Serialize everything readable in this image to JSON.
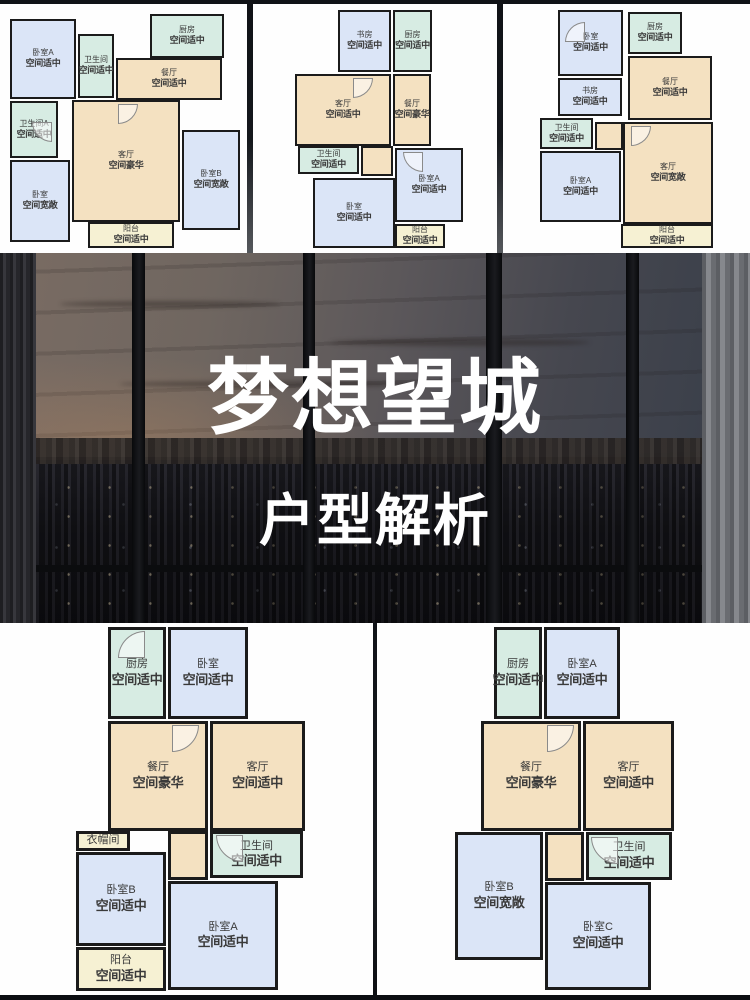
{
  "hero": {
    "title": "梦想望城",
    "subtitle": "户型解析"
  },
  "palette": {
    "bedroom": "#dbe5f7",
    "utility": "#d7ece3",
    "living": "#f4e1c1",
    "balcony": "#f6f1d3",
    "wall": "#1b1b1b",
    "card": "#fefefe",
    "text": "#3a3a3a"
  },
  "plans": [
    {
      "id": "plan-top-left",
      "rooms": [
        {
          "name": "卧室A",
          "grade": "空间适中",
          "type": "bedroom",
          "x": 10,
          "y": 15,
          "w": 66,
          "h": 80
        },
        {
          "name": "卫生间",
          "grade": "空间适中",
          "type": "utility",
          "x": 78,
          "y": 30,
          "w": 36,
          "h": 64
        },
        {
          "name": "厨房",
          "grade": "空间适中",
          "type": "utility",
          "x": 150,
          "y": 10,
          "w": 74,
          "h": 44
        },
        {
          "name": "餐厅",
          "grade": "空间适中",
          "type": "living",
          "x": 116,
          "y": 54,
          "w": 106,
          "h": 42
        },
        {
          "name": "卫生间A",
          "grade": "空间适中",
          "type": "utility",
          "x": 10,
          "y": 97,
          "w": 48,
          "h": 57
        },
        {
          "name": "客厅",
          "grade": "空间豪华",
          "type": "living",
          "x": 72,
          "y": 96,
          "w": 108,
          "h": 122
        },
        {
          "name": "卧室",
          "grade": "空间宽敞",
          "type": "bedroom",
          "x": 10,
          "y": 156,
          "w": 60,
          "h": 82
        },
        {
          "name": "卧室B",
          "grade": "空间宽敞",
          "type": "bedroom",
          "x": 182,
          "y": 126,
          "w": 58,
          "h": 100
        },
        {
          "name": "阳台",
          "grade": "空间适中",
          "type": "balcony",
          "x": 88,
          "y": 218,
          "w": 86,
          "h": 26
        }
      ],
      "doors": [
        {
          "x": 118,
          "y": 100,
          "rot": 0
        },
        {
          "x": 32,
          "y": 118,
          "rot": 90
        }
      ]
    },
    {
      "id": "plan-top-middle",
      "rooms": [
        {
          "name": "书房",
          "grade": "空间适中",
          "type": "bedroom",
          "x": 85,
          "y": 6,
          "w": 53,
          "h": 62
        },
        {
          "name": "厨房",
          "grade": "空间适中",
          "type": "utility",
          "x": 140,
          "y": 6,
          "w": 39,
          "h": 62
        },
        {
          "name": "客厅",
          "grade": "空间适中",
          "type": "living",
          "x": 42,
          "y": 70,
          "w": 96,
          "h": 72
        },
        {
          "name": "餐厅",
          "grade": "空间豪华",
          "type": "living",
          "x": 140,
          "y": 70,
          "w": 38,
          "h": 72
        },
        {
          "name": "",
          "grade": "",
          "type": "living",
          "x": 108,
          "y": 142,
          "w": 32,
          "h": 30
        },
        {
          "name": "卫生间",
          "grade": "空间适中",
          "type": "utility",
          "x": 45,
          "y": 142,
          "w": 61,
          "h": 28
        },
        {
          "name": "卧室A",
          "grade": "空间适中",
          "type": "bedroom",
          "x": 142,
          "y": 144,
          "w": 68,
          "h": 74
        },
        {
          "name": "卧室",
          "grade": "空间适中",
          "type": "bedroom",
          "x": 60,
          "y": 174,
          "w": 82,
          "h": 70
        },
        {
          "name": "阳台",
          "grade": "空间适中",
          "type": "balcony",
          "x": 142,
          "y": 220,
          "w": 50,
          "h": 24
        }
      ],
      "doors": [
        {
          "x": 100,
          "y": 74,
          "rot": 0
        },
        {
          "x": 150,
          "y": 148,
          "rot": 90
        }
      ]
    },
    {
      "id": "plan-top-right",
      "rooms": [
        {
          "name": "卧室",
          "grade": "空间适中",
          "type": "bedroom",
          "x": 55,
          "y": 6,
          "w": 65,
          "h": 66
        },
        {
          "name": "厨房",
          "grade": "空间适中",
          "type": "utility",
          "x": 125,
          "y": 8,
          "w": 54,
          "h": 42
        },
        {
          "name": "餐厅",
          "grade": "空间适中",
          "type": "living",
          "x": 125,
          "y": 52,
          "w": 84,
          "h": 64
        },
        {
          "name": "书房",
          "grade": "空间适中",
          "type": "bedroom",
          "x": 55,
          "y": 74,
          "w": 64,
          "h": 38
        },
        {
          "name": "卫生间",
          "grade": "空间适中",
          "type": "utility",
          "x": 37,
          "y": 114,
          "w": 53,
          "h": 31
        },
        {
          "name": "",
          "grade": "",
          "type": "living",
          "x": 92,
          "y": 118,
          "w": 28,
          "h": 28
        },
        {
          "name": "客厅",
          "grade": "空间宽敞",
          "type": "living",
          "x": 120,
          "y": 118,
          "w": 90,
          "h": 102
        },
        {
          "name": "卧室A",
          "grade": "空间适中",
          "type": "bedroom",
          "x": 37,
          "y": 147,
          "w": 81,
          "h": 71
        },
        {
          "name": "阳台",
          "grade": "空间适中",
          "type": "balcony",
          "x": 118,
          "y": 220,
          "w": 92,
          "h": 24
        }
      ],
      "doors": [
        {
          "x": 128,
          "y": 122,
          "rot": 0
        },
        {
          "x": 62,
          "y": 18,
          "rot": 180
        }
      ]
    },
    {
      "id": "plan-bottom-left",
      "rooms": [
        {
          "name": "厨房",
          "grade": "空间适中",
          "type": "utility",
          "x": 108,
          "y": 4,
          "w": 58,
          "h": 92
        },
        {
          "name": "卧室",
          "grade": "空间适中",
          "type": "bedroom",
          "x": 168,
          "y": 4,
          "w": 80,
          "h": 92
        },
        {
          "name": "餐厅",
          "grade": "空间豪华",
          "type": "living",
          "x": 108,
          "y": 98,
          "w": 100,
          "h": 110
        },
        {
          "name": "客厅",
          "grade": "空间适中",
          "type": "living",
          "x": 210,
          "y": 98,
          "w": 95,
          "h": 110
        },
        {
          "name": "",
          "grade": "",
          "type": "living",
          "x": 168,
          "y": 208,
          "w": 40,
          "h": 49
        },
        {
          "name": "衣帽间",
          "grade": "",
          "type": "balcony",
          "x": 76,
          "y": 208,
          "w": 54,
          "h": 20
        },
        {
          "name": "卫生间",
          "grade": "空间适中",
          "type": "utility",
          "x": 210,
          "y": 208,
          "w": 93,
          "h": 47
        },
        {
          "name": "卧室B",
          "grade": "空间适中",
          "type": "bedroom",
          "x": 76,
          "y": 229,
          "w": 90,
          "h": 94
        },
        {
          "name": "卧室A",
          "grade": "空间适中",
          "type": "bedroom",
          "x": 168,
          "y": 258,
          "w": 110,
          "h": 109
        },
        {
          "name": "阳台",
          "grade": "空间适中",
          "type": "balcony",
          "x": 76,
          "y": 324,
          "w": 90,
          "h": 44
        }
      ],
      "doors": [
        {
          "x": 172,
          "y": 102,
          "rot": 0
        },
        {
          "x": 216,
          "y": 212,
          "rot": 90
        },
        {
          "x": 118,
          "y": 8,
          "rot": 180
        }
      ]
    },
    {
      "id": "plan-bottom-right",
      "rooms": [
        {
          "name": "厨房",
          "grade": "空间适中",
          "type": "utility",
          "x": 117,
          "y": 4,
          "w": 48,
          "h": 92
        },
        {
          "name": "卧室A",
          "grade": "空间适中",
          "type": "bedroom",
          "x": 167,
          "y": 4,
          "w": 76,
          "h": 92
        },
        {
          "name": "餐厅",
          "grade": "空间豪华",
          "type": "living",
          "x": 104,
          "y": 98,
          "w": 100,
          "h": 110
        },
        {
          "name": "客厅",
          "grade": "空间适中",
          "type": "living",
          "x": 206,
          "y": 98,
          "w": 91,
          "h": 110
        },
        {
          "name": "",
          "grade": "",
          "type": "living",
          "x": 168,
          "y": 209,
          "w": 39,
          "h": 49
        },
        {
          "name": "卫生间",
          "grade": "空间适中",
          "type": "utility",
          "x": 209,
          "y": 209,
          "w": 86,
          "h": 48
        },
        {
          "name": "卧室B",
          "grade": "空间宽敞",
          "type": "bedroom",
          "x": 78,
          "y": 209,
          "w": 88,
          "h": 128
        },
        {
          "name": "卧室C",
          "grade": "空间适中",
          "type": "bedroom",
          "x": 168,
          "y": 259,
          "w": 106,
          "h": 108
        }
      ],
      "doors": [
        {
          "x": 170,
          "y": 102,
          "rot": 0
        },
        {
          "x": 214,
          "y": 214,
          "rot": 90
        }
      ]
    }
  ]
}
